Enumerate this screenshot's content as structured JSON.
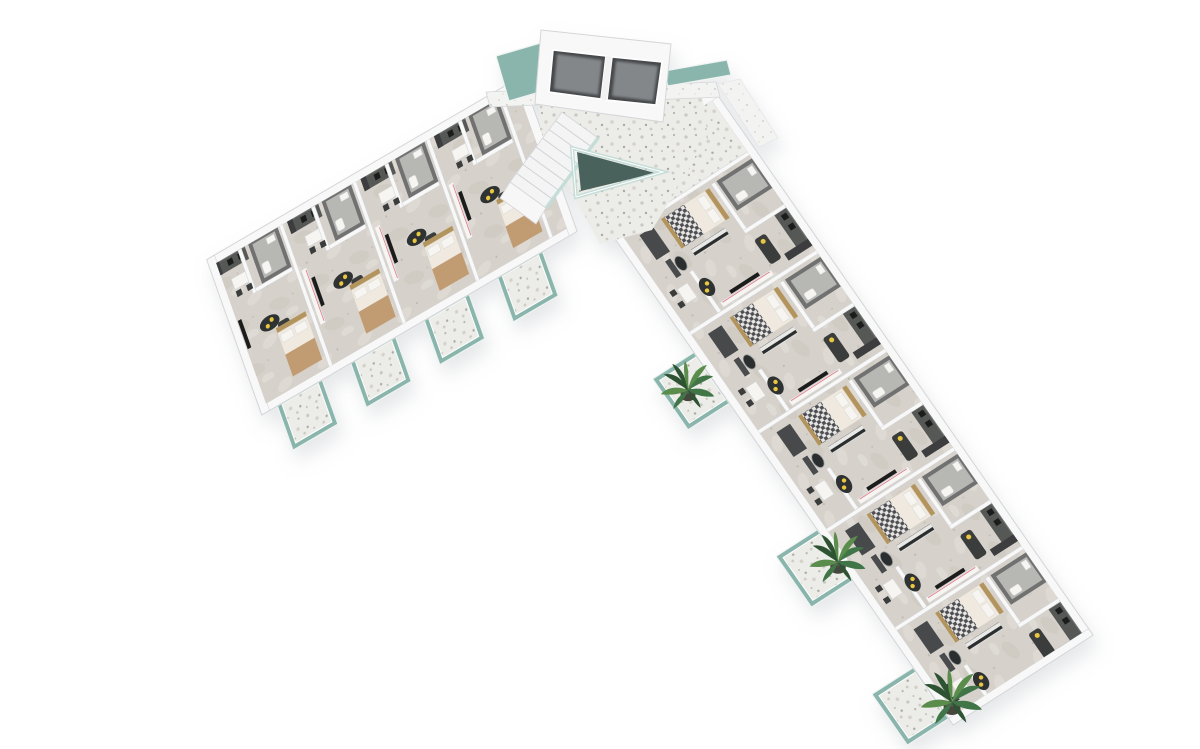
{
  "scene": {
    "name": "3D isometric floor plan render of an L-shaped apartment building, viewed from above",
    "background": "plain white",
    "core": {
      "elevators": 2,
      "staircase": true,
      "skylight_shape": "triangular",
      "lobby_floor": "light terrazzo"
    },
    "wings": [
      {
        "name": "west-wing",
        "direction": "runs toward lower-left",
        "units_visible": 4,
        "balconies": 4,
        "plants": 0
      },
      {
        "name": "east-wing",
        "direction": "runs toward lower-right",
        "units_visible": 5,
        "balconies": 3,
        "plants": 3
      }
    ],
    "furnishing": "gray kitchens and bathroom cores, beds with gold frames, dark sofas with yellow cushions, oval coffee tables, white dining tables, TV sideboards with red cable lines",
    "balcony_railing": "teal glass"
  },
  "palette": {
    "bg": "#ffffff",
    "wallTop": "#f8f8f9",
    "wallShade": "#e8e9eb",
    "wallEdge": "#d5d6d8",
    "white": "#f6f5f2",
    "bathWall": "#6f7170",
    "bathFloor": "#b7b8b4",
    "kitchen": "#565857",
    "kitchenTop": "#717372",
    "black": "#1c1e1f",
    "furnDark": "#3a3c3e",
    "gold": "#b3945c",
    "yellow": "#e9c73f",
    "glass": "#8ab5ac",
    "glassLight": "#c2dcd6",
    "glassFrame": "#eef3f1",
    "skylight": "#49635c",
    "tan": "#c19c72",
    "bedBase": "#efe9df",
    "bedEdge": "#d9d2c6",
    "redLine": "#e07f8e",
    "glassDoor": "#e4e5e7",
    "pot": "#45463e",
    "plantDark": "#2d5233",
    "plantMid": "#3f7447",
    "plantLight": "#5a8c4c"
  }
}
